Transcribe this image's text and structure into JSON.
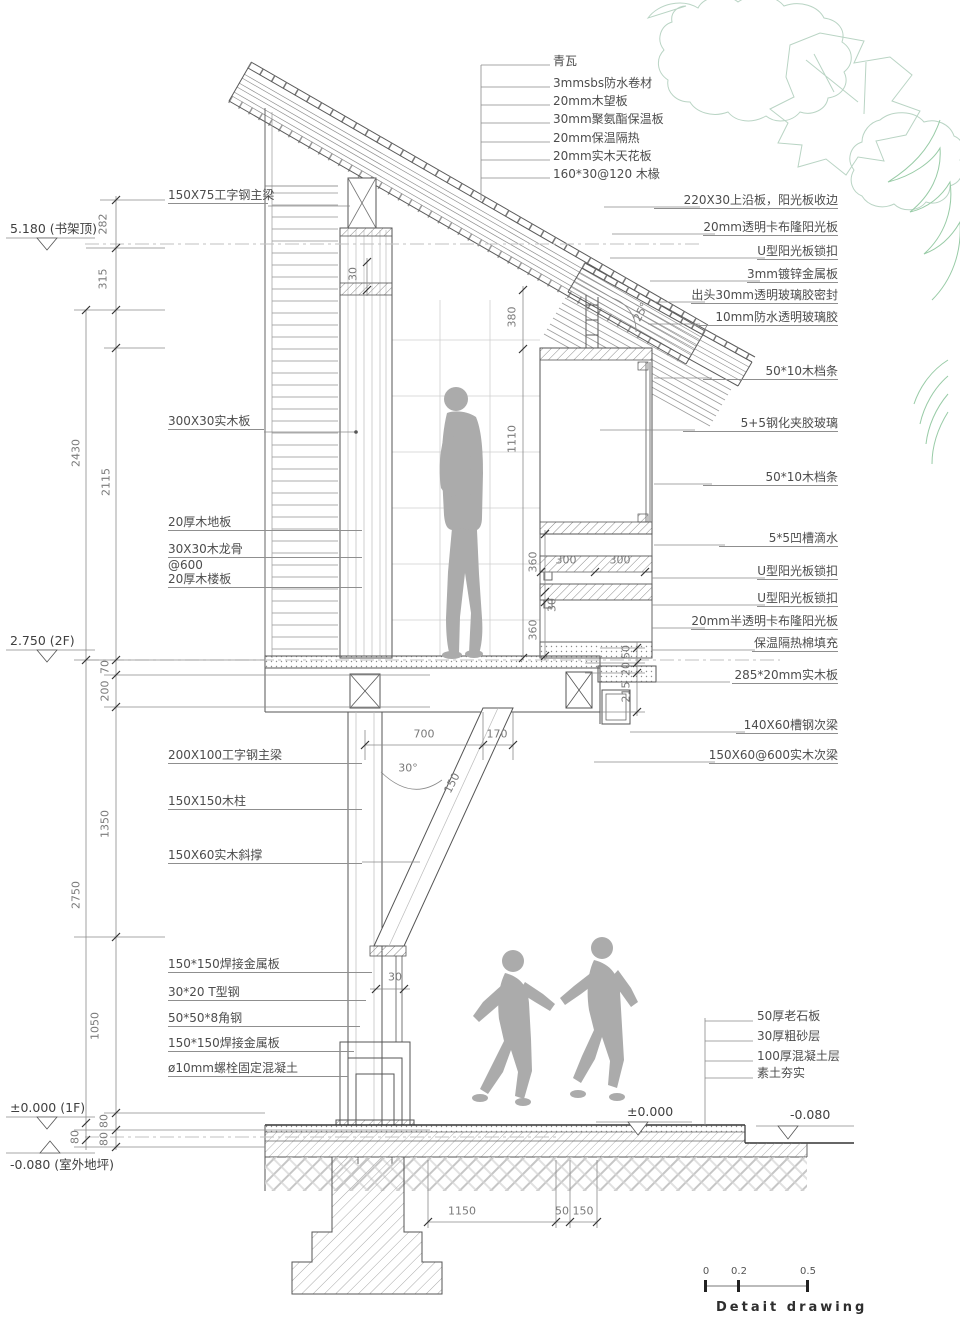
{
  "drawing": {
    "roof_stack_labels": [
      "青瓦",
      "3mmsbs防水卷材",
      "20mm木望板",
      "30mm聚氨酯保温板",
      "20mm保温隔热",
      "20mm实木天花板",
      "160*30@120 木椽"
    ],
    "right_labels": [
      "220X30上沿板，阳光板收边",
      "20mm透明卡布隆阳光板",
      "U型阳光板锁扣",
      "3mm镀锌金属板",
      "出头30mm透明玻璃胶密封",
      "10mm防水透明玻璃胶",
      "50*10木档条",
      "5+5钢化夹胶玻璃",
      "50*10木档条",
      "5*5凹槽滴水",
      "U型阳光板锁扣",
      "U型阳光板锁扣",
      "20mm半透明卡布隆阳光板",
      "保温隔热棉填充",
      "285*20mm实木板",
      "140X60槽钢次梁",
      "150X60@600实木次梁"
    ],
    "left_labels": [
      "150X75工字钢主梁",
      "300X30实木板",
      "20厚木地板",
      "30X30木龙骨",
      "@600",
      "20厚木楼板",
      "200X100工字钢主梁",
      "150X150木柱",
      "150X60实木斜撑",
      "150*150焊接金属板",
      "30*20 T型钢",
      "50*50*8角钢",
      "150*150焊接金属板",
      "ø10mm螺栓固定混凝土"
    ],
    "ground_labels": [
      "50厚老石板",
      "30厚粗砂层",
      "100厚混凝土层",
      "素土夯实"
    ],
    "levels": {
      "shelf_top": {
        "elev": "5.180",
        "note": "(书架顶)"
      },
      "floor2": {
        "elev": "2.750",
        "note": "(2F)"
      },
      "floor1": {
        "elev": "±0.000",
        "note": "(1F)"
      },
      "outdoor": {
        "elev": "-0.080",
        "note": "(室外地坪)"
      },
      "slab_top": {
        "elev": "±0.000"
      },
      "grade": {
        "elev": "-0.080"
      }
    },
    "dims": {
      "d282": "282",
      "d315": "315",
      "d2430": "2430",
      "d2115": "2115",
      "d70": "70",
      "d200": "200",
      "d1350": "1350",
      "d2750": "2750",
      "d1050": "1050",
      "d80a": "80",
      "d80b": "80",
      "d80c": "80",
      "d30top": "30",
      "d380": "380",
      "d1110": "1110",
      "d360a": "360",
      "d30mid": "30",
      "d360b": "360",
      "d300a": "300",
      "d300b": "300",
      "d50": "50",
      "d20": "20",
      "d215": "215",
      "d700": "700",
      "d170": "170",
      "d150": "150",
      "a30": "30°",
      "a25": "25°",
      "d30brace": "30",
      "d1150": "1150",
      "d50b": "50",
      "d150b": "150"
    },
    "scale_bar": {
      "t0": "0",
      "t1": "0.2",
      "t2": "0.5",
      "caption": "Detait drawing"
    }
  },
  "colors": {
    "line": "#555555",
    "light": "#9a9a9a",
    "figure": "#ababab",
    "tree": "#b9d4c4",
    "tree2": "#98cba6",
    "dash": "#c2c2c2"
  }
}
